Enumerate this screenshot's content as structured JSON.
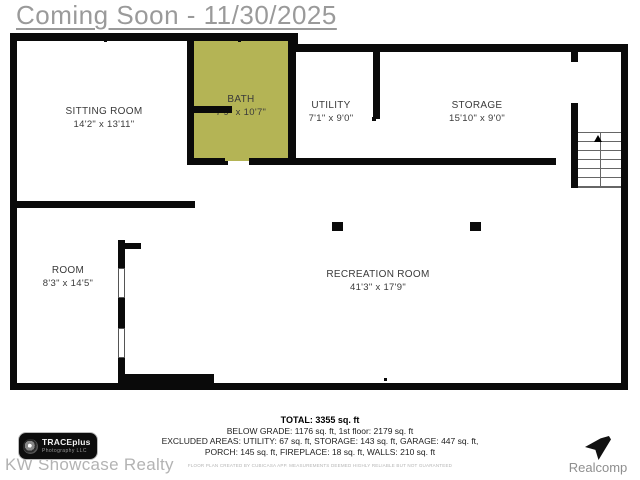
{
  "header": {
    "title": "Coming Soon - 11/30/2025"
  },
  "rooms": [
    {
      "name": "SITTING ROOM",
      "dims": "14'2\" x 13'11\""
    },
    {
      "name": "BATH",
      "dims": "7'9\" x 10'7\""
    },
    {
      "name": "UTILITY",
      "dims": "7'1\" x 9'0\""
    },
    {
      "name": "STORAGE",
      "dims": "15'10\" x 9'0\""
    },
    {
      "name": "ROOM",
      "dims": "8'3\" x 14'5\""
    },
    {
      "name": "RECREATION ROOM",
      "dims": "41'3\" x 17'9\""
    }
  ],
  "summary": {
    "total": "TOTAL: 3355 sq. ft",
    "line2": "BELOW GRADE: 1176 sq. ft, 1st floor: 2179 sq. ft",
    "line3": "EXCLUDED AREAS: UTILITY: 67 sq. ft, STORAGE: 143 sq. ft, GARAGE: 447 sq. ft,",
    "line4": "PORCH: 145 sq. ft, FIREPLACE: 18 sq. ft, WALLS: 210 sq. ft",
    "disclaimer": "FLOOR PLAN CREATED BY CUBICASA APP. MEASUREMENTS DEEMED HIGHLY RELIABLE BUT NOT GUARANTEED"
  },
  "branding": {
    "photographer_line1": "TRACEplus",
    "photographer_line2": "Photography LLC",
    "agency": "KW Showcase Realty",
    "mls": "Realcomp"
  },
  "colors": {
    "bath_fill": "#b4b455",
    "wall": "#0a0a0a",
    "header_text": "#9a9a9a"
  }
}
